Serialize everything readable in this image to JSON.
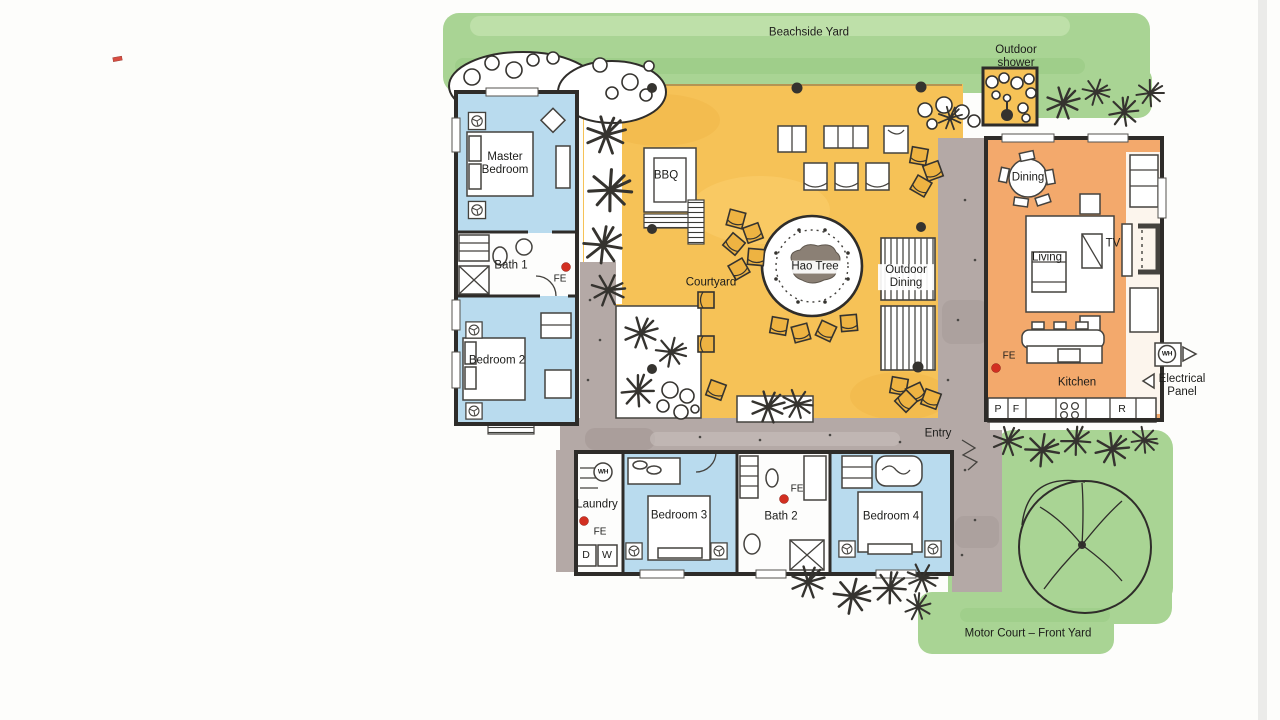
{
  "plan": {
    "outdoor": {
      "beachside_yard": "Beachside Yard",
      "outdoor_shower": "Outdoor shower",
      "courtyard": "Courtyard",
      "hao_tree": "Hao Tree",
      "outdoor_dining": "Outdoor Dining",
      "bbq": "BBQ",
      "entry": "Entry",
      "motor_court": "Motor Court – Front Yard"
    },
    "rooms": {
      "master_bedroom": "Master Bedroom",
      "bath_1": "Bath 1",
      "bedroom_2": "Bedroom 2",
      "bedroom_3": "Bedroom 3",
      "bath_2": "Bath 2",
      "bedroom_4": "Bedroom 4",
      "laundry": "Laundry",
      "dining": "Dining",
      "living": "Living",
      "kitchen": "Kitchen",
      "tv": "TV"
    },
    "annotations": {
      "fire_extinguisher": "FE",
      "water_heater": "WH",
      "electrical_panel": "Electrical Panel"
    },
    "appliances": {
      "p": "P",
      "f": "F",
      "r": "R",
      "d": "D",
      "w": "W"
    },
    "colors": {
      "paper_white": "#fdfdfb",
      "yard_green": "#a9d494",
      "yard_green_light": "#c3e2ae",
      "courtyard_yellow": "#f6c257",
      "courtyard_yellow_deep": "#eeb342",
      "bedroom_blue": "#b9dbee",
      "living_orange": "#f3a96c",
      "walkway_gray": "#b4a9a6",
      "wall_dark": "#2e2c29",
      "fire_red": "#d22f21",
      "tree_gray": "#8b8075",
      "ink": "#3a3a36"
    }
  }
}
